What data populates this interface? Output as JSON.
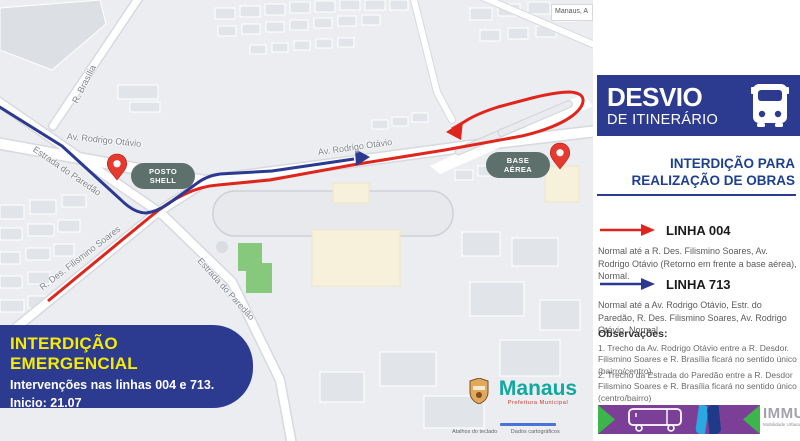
{
  "colors": {
    "panel_blue": "#2c3a90",
    "text_blue": "#1d3f92",
    "route_red": "#e0251d",
    "route_blue": "#2b3990",
    "highlight_yellow": "#f6ec00",
    "immu_purple": "#7c3f97",
    "immu_green": "#3cb54a",
    "immu_gray": "#a3a2ad",
    "poi_pill": "#5d706c",
    "manaus_teal": "#13a89e",
    "pin_red": "#e63a2e"
  },
  "map": {
    "search_label": "Manaus, A",
    "streets": {
      "brasilia": "R. Brasília",
      "av_rodrigo_otavio_west": "Av. Rodrigo Otávio",
      "av_rodrigo_otavio_center": "Av. Rodrigo Otávio",
      "estrada_paredao_upper": "Estrada do Paredão",
      "estrada_paredao_lower": "Estrada do Paredão",
      "filismino_soares": "R. Des. Filismino Soares"
    },
    "pois": {
      "posto_shell": {
        "line1": "POSTO",
        "line2": "SHELL"
      },
      "base_aerea": {
        "line1": "BASE",
        "line2": "AÉREA"
      }
    },
    "notice": {
      "title": "INTERDIÇÃO EMERGENCIAL",
      "line1": "Intervenções nas linhas 004 e 713.",
      "line2": "Inicio: 21.07"
    },
    "logo": {
      "city": "Manaus",
      "subtitle": "Prefeitura Municipal"
    },
    "attribution": {
      "shortcuts": "Atalhos do teclado",
      "data": "Dados cartográficos"
    }
  },
  "panel": {
    "header": {
      "title": "DESVIO",
      "subtitle": "DE ITINERÁRIO"
    },
    "section": {
      "line1": "INTERDIÇÃO PARA",
      "line2": "REALIZAÇÃO DE OBRAS"
    },
    "lines": [
      {
        "label": "LINHA 004",
        "description": "Normal até a R. Des. Filismino Soares, Av. Rodrigo Otávio (Retorno em frente a base aérea), Normal."
      },
      {
        "label": "LINHA 713",
        "description": "Normal até a Av. Rodrigo Otávio, Estr. do Paredão, R. Des. Filismino Soares, Av. Rodrigo Otávio, Normal"
      }
    ],
    "observations": {
      "title": "Observações:",
      "items": [
        "1. Trecho da Av. Rodrigo Otávio entre a R. Desdor. Filismino Soares e R. Brasília ficará no sentido único (bairro/centro).",
        "2. Trecho da Estrada do Paredão entre a R. Desdor Filismino Soares e R. Brasília ficará no sentido único (centro/bairro)"
      ]
    },
    "footer": {
      "brand": "IMMU",
      "brand_subtitle": "Mobilidade Urbana"
    }
  }
}
